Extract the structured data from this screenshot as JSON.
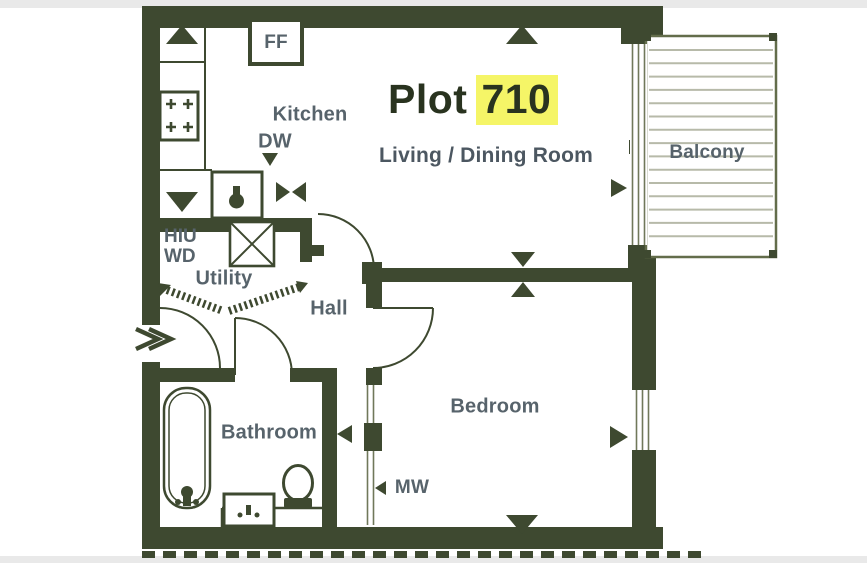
{
  "floor_plan": {
    "title": {
      "prefix": "Plot",
      "number": "710"
    },
    "rooms": {
      "kitchen": "Kitchen",
      "living_dining": "Living / Dining Room",
      "hall": "Hall",
      "utility": "Utility",
      "bathroom": "Bathroom",
      "bedroom": "Bedroom",
      "balcony": "Balcony"
    },
    "labels": {
      "ff": "FF",
      "dw": "DW",
      "hiu": "HIU",
      "wd": "WD",
      "mw": "MW"
    },
    "colors": {
      "wall": "#3e4930",
      "room_label": "#57636b",
      "title_text": "#29331f",
      "highlight": "#f5f567",
      "balcony_frame": "#636d4b",
      "deck_line": "#b7baa9",
      "background": "#ffffff",
      "gutter": "#e9e9e9"
    }
  }
}
